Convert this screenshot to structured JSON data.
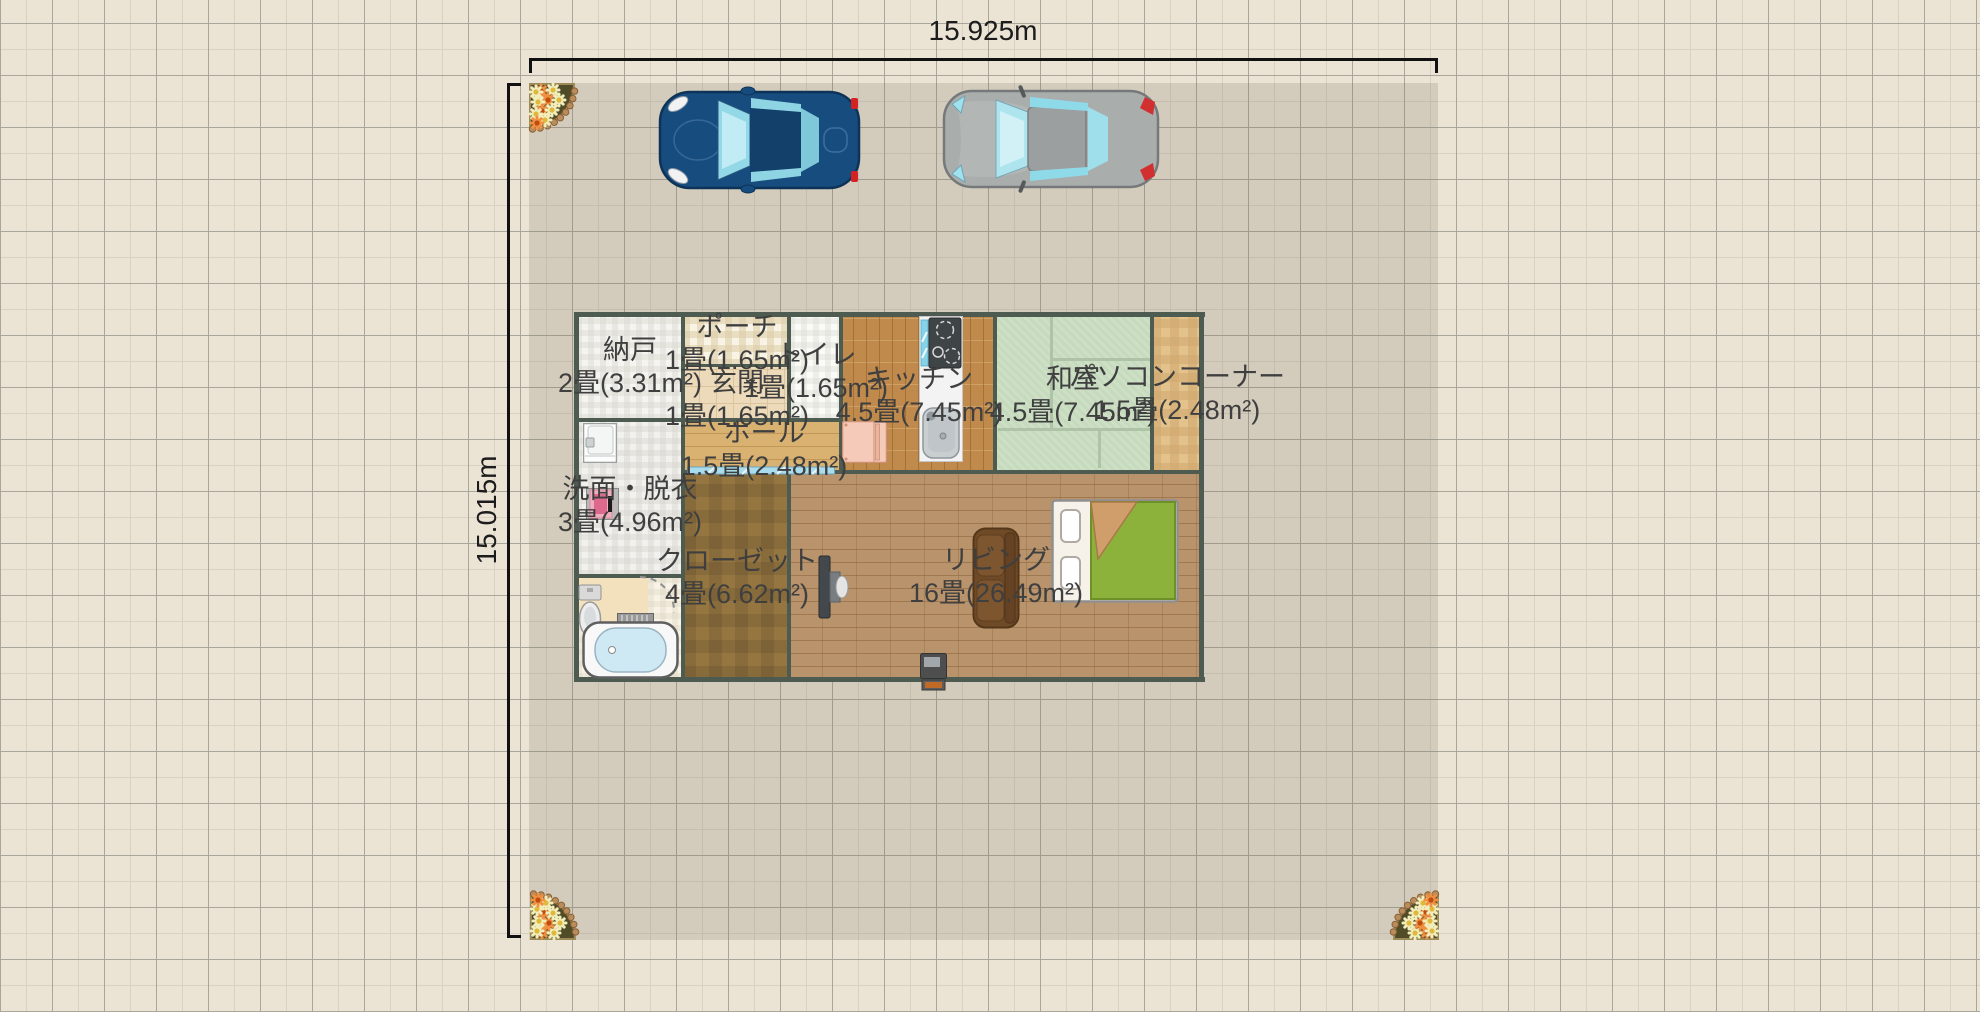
{
  "floor_plan": {
    "dimension_width": "15.925m",
    "dimension_height": "15.015m",
    "rooms": {
      "storage": {
        "name": "納戸",
        "area": "2畳(3.31m²)"
      },
      "porch": {
        "name": "ポーチ",
        "area": "1畳(1.65m²)"
      },
      "toilet": {
        "name": "トイレ",
        "area": "1畳(1.65m²)"
      },
      "entrance": {
        "name": "玄関",
        "area": "1畳(1.65m²)"
      },
      "hall": {
        "name": "ホール",
        "area": "1.5畳(2.48m²)"
      },
      "kitchen": {
        "name": "キッチン",
        "area": "4.5畳(7.45m²)"
      },
      "tatami": {
        "name": "和室",
        "area": "4.5畳(7.45m²)"
      },
      "pc_corner": {
        "name": "パソコンコーナー",
        "area": "1.5畳(2.48m²)"
      },
      "washroom": {
        "name": "洗面・脱衣",
        "area": "3畳(4.96m²)"
      },
      "closet": {
        "name": "クローゼット",
        "area": "4畳(6.62m²)"
      },
      "living": {
        "name": "リビング",
        "area": "16畳(26.49m²)"
      }
    },
    "objects": {
      "cars": [
        "car-blue",
        "car-gray"
      ],
      "flower_beds": 3,
      "fixtures": [
        "kitchen-counter",
        "refrigerator",
        "washbasin",
        "washing-machine",
        "toilet",
        "bathtub",
        "shower-mat",
        "door-swing-arc",
        "sliding-door",
        "tv",
        "sofa",
        "bed",
        "stove"
      ]
    },
    "colors": {
      "wall": "#4d5b51",
      "plot": "#d4cfc2",
      "tatami": "#cde0c5",
      "living_floor": "#b8936c",
      "glass_blue": "#a9dcec",
      "bed_green": "#8cb23c"
    }
  }
}
